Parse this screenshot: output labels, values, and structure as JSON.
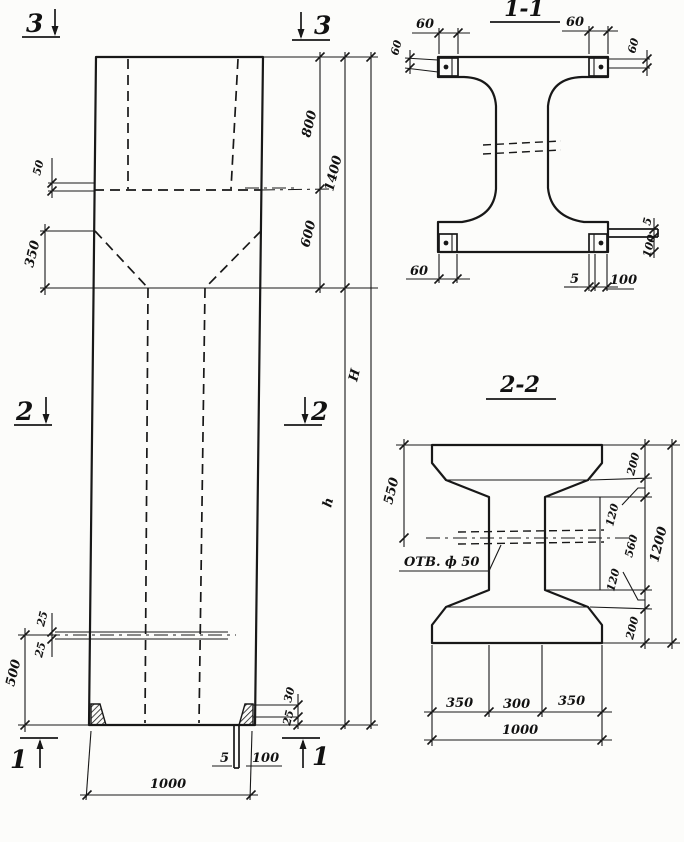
{
  "drawing": {
    "elevation": {
      "markers": {
        "s3_left": "3",
        "s3_right": "3",
        "s2_left": "2",
        "s2_right": "2",
        "s1_left": "1",
        "s1_right": "1"
      },
      "dims": {
        "shelf_50": "50",
        "taper_350": "350",
        "top_800": "800",
        "mid_600": "600",
        "top_total_1400": "1400",
        "lower_h": "h",
        "total_H": "H",
        "hole_offset_top_25": "25",
        "hole_offset_bottom_25": "25",
        "hole_bottom_500": "500",
        "plate_30": "30",
        "plate_25": "25",
        "plate_thickness_5": "5",
        "plate_width_100": "100",
        "width_1000": "1000"
      }
    },
    "section_1_1": {
      "title": "1-1",
      "dims": {
        "top_left_60": "60",
        "top_right_60": "60",
        "side_left_60": "60",
        "side_right_60": "60",
        "bottom_left_60": "60",
        "bottom_5": "5",
        "bottom_100": "100",
        "right_5": "5",
        "right_100": "100"
      }
    },
    "section_2_2": {
      "title": "2-2",
      "hole_label": "ОТВ. ф 50",
      "dims": {
        "left_550": "550",
        "right_200_top": "200",
        "right_120_top": "120",
        "right_560": "560",
        "right_120_bottom": "120",
        "right_200_bottom": "200",
        "right_total_1200": "1200",
        "bottom_350_left": "350",
        "bottom_300": "300",
        "bottom_350_right": "350",
        "bottom_1000": "1000"
      }
    }
  }
}
